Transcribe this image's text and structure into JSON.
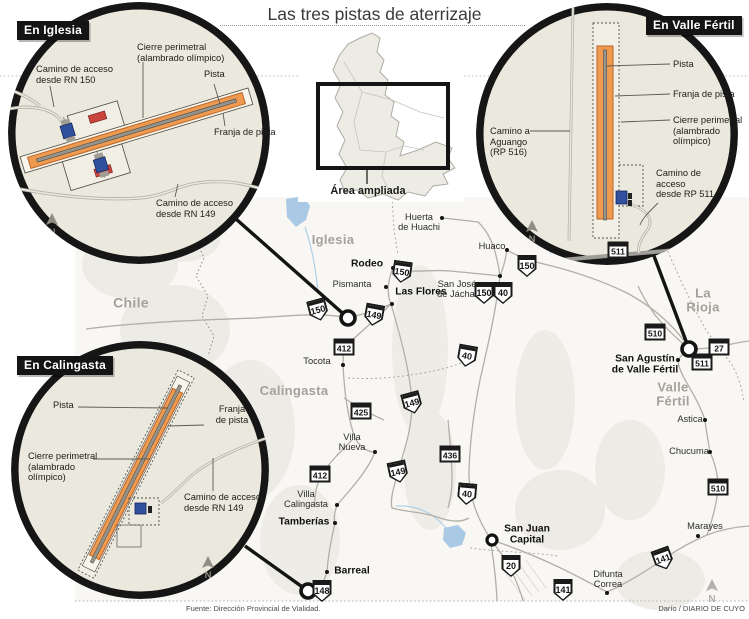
{
  "title": "Las tres pistas de aterrizaje",
  "overview": {
    "label": "Área ampliada"
  },
  "footer": {
    "source": "Fuente: Dirección Provincial de Vialidad.",
    "credit": "Darío / DIARIO DE CUYO"
  },
  "colors": {
    "runway_orange": "#ee9a50",
    "runway_border": "#bf6c2f",
    "circle_fill": "#ebe9dd",
    "ring_black": "#161616",
    "gate_blue": "#31519f",
    "building_red": "#c8443c"
  },
  "insets": {
    "iglesia": {
      "title": "En Iglesia",
      "labels": {
        "cierre": "Cierre perimetral\n(alambrado olímpico)",
        "acceso150": "Camino de acceso\ndesde RN 150",
        "pista": "Pista",
        "franja": "Franja de pista",
        "acceso149": "Camino de acceso\ndesde RN 149",
        "north": "N"
      }
    },
    "valle": {
      "title": "En Valle Fértil",
      "labels": {
        "pista": "Pista",
        "franja": "Franja de pista",
        "cierre": "Cierre perimetral\n(alambrado\nolímpico)",
        "aguango": "Camino a\nAguango\n(RP 516)",
        "acceso511": "Camino de\nacceso\ndesde RP 511",
        "north": "N"
      }
    },
    "calingasta": {
      "title": "En Calingasta",
      "labels": {
        "pista": "Pista",
        "franja": "Franja\nde pista",
        "cierre": "Cierre perimetral\n(alambrado\nolímpico)",
        "acceso149": "Camino de acceso\ndesde RN 149",
        "north": "N"
      }
    }
  },
  "map": {
    "north_label": "N",
    "regions": [
      {
        "name": "Chile",
        "x": 131,
        "y": 303,
        "size": 14
      },
      {
        "name": "Iglesia",
        "x": 333,
        "y": 240,
        "size": 13
      },
      {
        "name": "Calingasta",
        "x": 294,
        "y": 391,
        "size": 13
      },
      {
        "name": "La Rioja",
        "x": 703,
        "y": 300,
        "size": 13
      },
      {
        "name": "Valle\nFértil",
        "x": 673,
        "y": 394,
        "size": 13
      }
    ],
    "towns": [
      {
        "name": "Rodeo",
        "x": 367,
        "y": 264,
        "bold": true,
        "dot": [
          393,
          268
        ]
      },
      {
        "name": "Pismanta",
        "x": 352,
        "y": 284,
        "bold": false,
        "dot": [
          386,
          287
        ]
      },
      {
        "name": "Las Flores",
        "x": 421,
        "y": 292,
        "bold": true,
        "dot": [
          392,
          304
        ]
      },
      {
        "name": "San José\nde Jáchal",
        "x": 457,
        "y": 289,
        "bold": false,
        "dot": [
          500,
          276
        ]
      },
      {
        "name": "Huerta\nde Huachi",
        "x": 419,
        "y": 222,
        "bold": false,
        "dot": [
          442,
          218
        ]
      },
      {
        "name": "Huaco",
        "x": 492,
        "y": 246,
        "bold": false,
        "dot": [
          507,
          250
        ]
      },
      {
        "name": "Tocota",
        "x": 317,
        "y": 361,
        "bold": false,
        "dot": [
          343,
          365
        ]
      },
      {
        "name": "Villa\nNueva",
        "x": 352,
        "y": 442,
        "bold": false,
        "dot": [
          375,
          452
        ]
      },
      {
        "name": "Villa\nCalingasta",
        "x": 306,
        "y": 499,
        "bold": false,
        "dot": [
          337,
          505
        ]
      },
      {
        "name": "Tamberías",
        "x": 304,
        "y": 522,
        "bold": true,
        "dot": [
          335,
          523
        ]
      },
      {
        "name": "Barreal",
        "x": 352,
        "y": 571,
        "bold": true,
        "dot": [
          327,
          572
        ]
      },
      {
        "name": "San Juan\nCapital",
        "x": 527,
        "y": 535,
        "bold": true,
        "dot": null
      },
      {
        "name": "Difunta\nCorrea",
        "x": 608,
        "y": 579,
        "bold": false,
        "dot": [
          607,
          593
        ]
      },
      {
        "name": "Marayes",
        "x": 705,
        "y": 526,
        "bold": false,
        "dot": [
          698,
          536
        ]
      },
      {
        "name": "San Agustín\nde Valle Fértil",
        "x": 645,
        "y": 365,
        "bold": true,
        "dot": [
          678,
          360
        ]
      },
      {
        "name": "Astica",
        "x": 690,
        "y": 419,
        "bold": false,
        "dot": [
          705,
          420
        ]
      },
      {
        "name": "Chucuma",
        "x": 689,
        "y": 451,
        "bold": false,
        "dot": [
          710,
          452
        ]
      }
    ],
    "shields": [
      {
        "n": "150",
        "t": "nat",
        "x": 318,
        "y": 310,
        "r": -15
      },
      {
        "n": "149",
        "t": "nat",
        "x": 374,
        "y": 315,
        "r": 10
      },
      {
        "n": "150",
        "t": "nat",
        "x": 402,
        "y": 272,
        "r": 8
      },
      {
        "n": "150",
        "t": "nat",
        "x": 484,
        "y": 293,
        "r": 0
      },
      {
        "n": "40",
        "t": "nat",
        "x": 503,
        "y": 293,
        "r": 0
      },
      {
        "n": "150",
        "t": "nat",
        "x": 527,
        "y": 266,
        "r": 0
      },
      {
        "n": "412",
        "t": "prov",
        "x": 344,
        "y": 347,
        "r": 0
      },
      {
        "n": "425",
        "t": "prov",
        "x": 361,
        "y": 411,
        "r": 0
      },
      {
        "n": "149",
        "t": "nat",
        "x": 412,
        "y": 403,
        "r": -15
      },
      {
        "n": "40",
        "t": "nat",
        "x": 467,
        "y": 356,
        "r": 10
      },
      {
        "n": "436",
        "t": "prov",
        "x": 450,
        "y": 454,
        "r": 0
      },
      {
        "n": "149",
        "t": "nat",
        "x": 398,
        "y": 472,
        "r": -12
      },
      {
        "n": "40",
        "t": "nat",
        "x": 467,
        "y": 494,
        "r": 5
      },
      {
        "n": "412",
        "t": "prov",
        "x": 320,
        "y": 474,
        "r": 0
      },
      {
        "n": "148",
        "t": "nat",
        "x": 322,
        "y": 591,
        "r": 0
      },
      {
        "n": "20",
        "t": "nat",
        "x": 511,
        "y": 566,
        "r": 0
      },
      {
        "n": "141",
        "t": "nat",
        "x": 563,
        "y": 590,
        "r": 0
      },
      {
        "n": "141",
        "t": "nat",
        "x": 663,
        "y": 559,
        "r": -20
      },
      {
        "n": "510",
        "t": "prov",
        "x": 655,
        "y": 332,
        "r": 0
      },
      {
        "n": "27",
        "t": "prov",
        "x": 719,
        "y": 347,
        "r": 0
      },
      {
        "n": "511",
        "t": "prov",
        "x": 702,
        "y": 362,
        "r": 0
      },
      {
        "n": "510",
        "t": "prov",
        "x": 718,
        "y": 487,
        "r": 0
      },
      {
        "n": "511",
        "t": "prov",
        "x": 618,
        "y": 250,
        "r": 0
      }
    ]
  }
}
